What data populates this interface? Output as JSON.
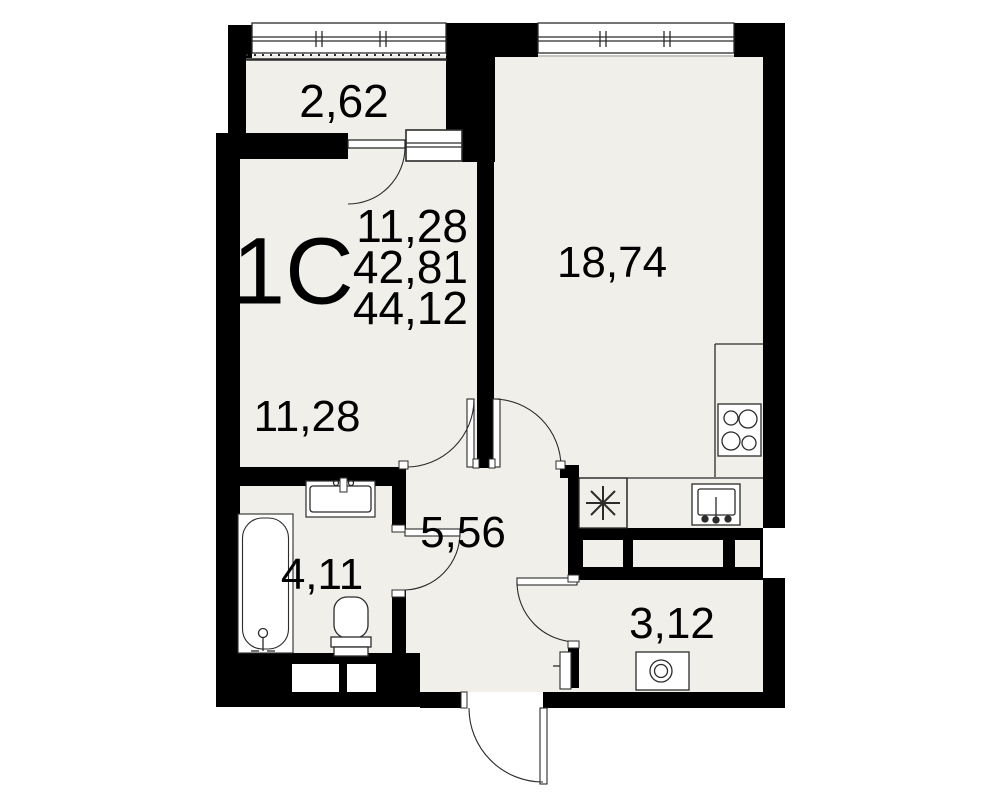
{
  "plan": {
    "unit_label": "1С",
    "areas": [
      "11,28",
      "42,81",
      "44,12"
    ],
    "rooms": {
      "balcony": "2,62",
      "living": "18,74",
      "room": "11,28",
      "hall": "5,56",
      "bath": "4,11",
      "storage": "3,12"
    },
    "colors": {
      "floor": "#f0efe9",
      "wall": "#000000",
      "line": "#2b2b2b",
      "bg": "#ffffff"
    },
    "icons": [
      "window-glazing",
      "balcony-railing",
      "door-swing-arc",
      "bathtub-icon",
      "bathroom-sink-icon",
      "toilet-icon",
      "washing-machine-icon",
      "fridge-asterisk-icon",
      "kitchen-sink-icon",
      "stove-icon",
      "kitchen-counter",
      "vent-shaft"
    ]
  }
}
